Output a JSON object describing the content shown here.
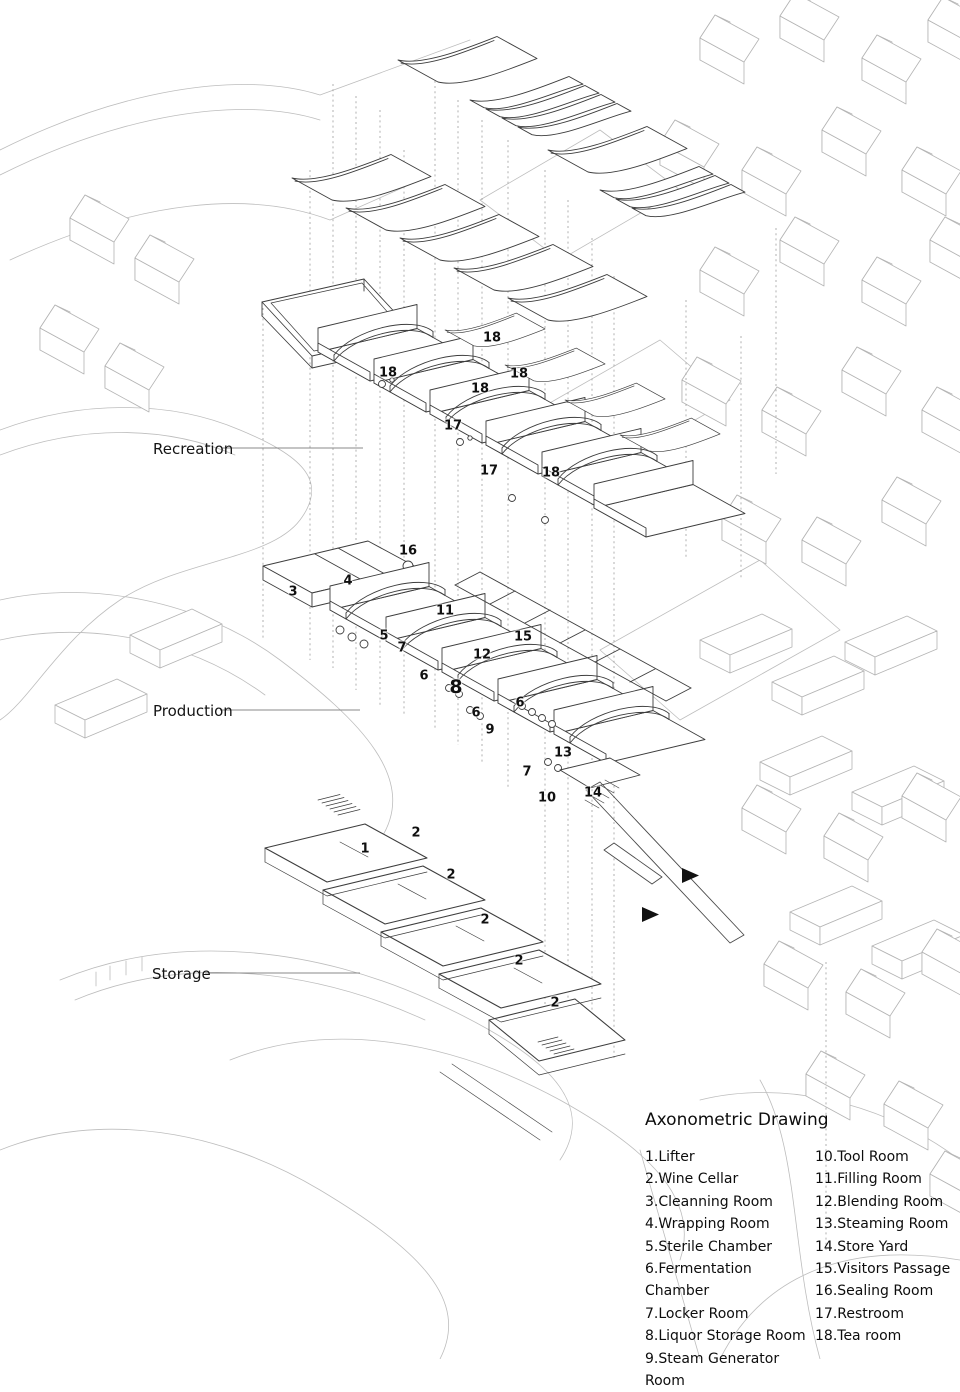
{
  "figure": {
    "type": "architectural axonometric drawing",
    "colors": {
      "main_line": "#3d3d3d",
      "context_line": "#b4b4b4",
      "text": "#111111",
      "arrow": "#111111"
    }
  },
  "sections": [
    {
      "label": "Recreation"
    },
    {
      "label": "Production"
    },
    {
      "label": "Storage"
    }
  ],
  "markers": [
    {
      "t": "18"
    },
    {
      "t": "18"
    },
    {
      "t": "18"
    },
    {
      "t": "18"
    },
    {
      "t": "17"
    },
    {
      "t": "17"
    },
    {
      "t": "18"
    },
    {
      "t": "16"
    },
    {
      "t": "4"
    },
    {
      "t": "3"
    },
    {
      "t": "11"
    },
    {
      "t": "5"
    },
    {
      "t": "15"
    },
    {
      "t": "7"
    },
    {
      "t": "12"
    },
    {
      "t": "6"
    },
    {
      "t": "8"
    },
    {
      "t": "6"
    },
    {
      "t": "6"
    },
    {
      "t": "9"
    },
    {
      "t": "13"
    },
    {
      "t": "7"
    },
    {
      "t": "14"
    },
    {
      "t": "10"
    },
    {
      "t": "2"
    },
    {
      "t": "1"
    },
    {
      "t": "2"
    },
    {
      "t": "2"
    },
    {
      "t": "2"
    },
    {
      "t": "2"
    }
  ],
  "legend": {
    "title": "Axonometric Drawing",
    "col1": [
      "1.Lifter",
      "2.Wine Cellar",
      "3.Cleanning Room",
      "4.Wrapping Room",
      "5.Sterile Chamber",
      "6.Fermentation Chamber",
      "7.Locker Room",
      "8.Liquor Storage Room",
      "9.Steam Generator Room"
    ],
    "col2": [
      "10.Tool Room",
      "11.Filling Room",
      "12.Blending Room",
      "13.Steaming Room",
      "14.Store Yard",
      "15.Visitors Passage",
      "16.Sealing Room",
      "17.Restroom",
      "18.Tea room"
    ]
  }
}
